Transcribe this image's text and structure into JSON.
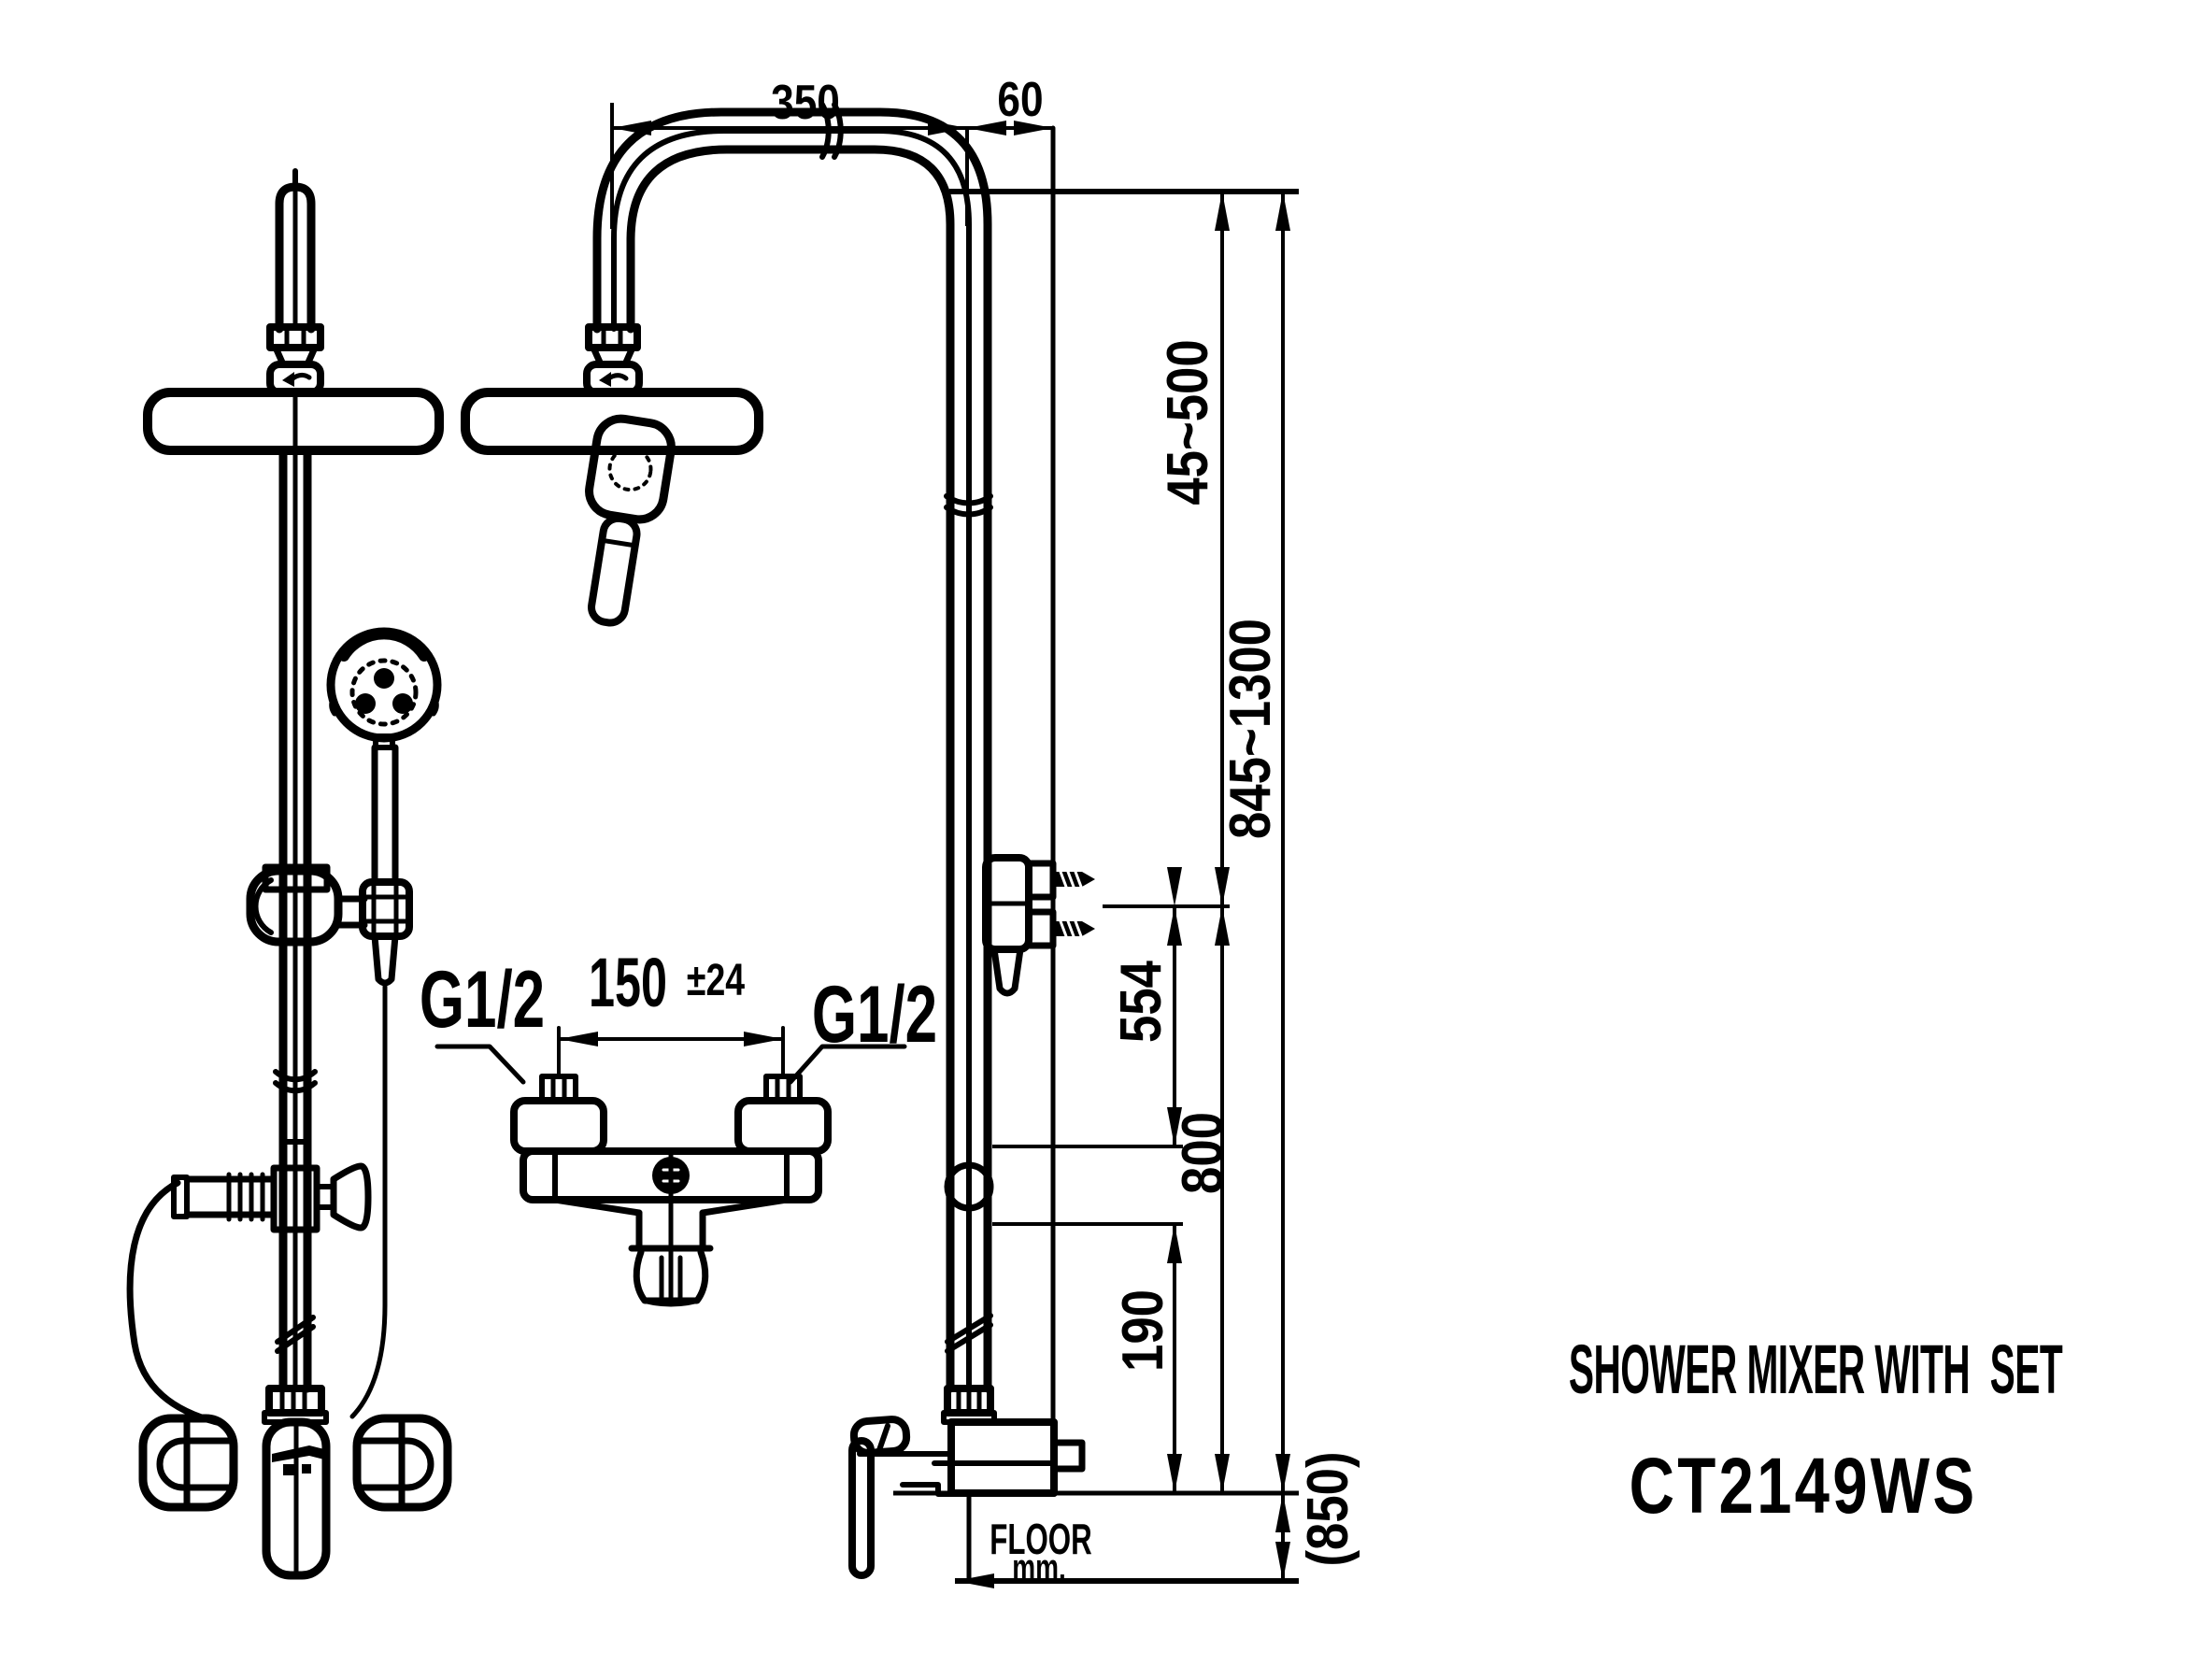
{
  "title": {
    "product_name": "SHOWER MIXER WITH  SET",
    "model_code": "CT2149WS"
  },
  "floor_reference": {
    "label": "FLOOR",
    "unit": "mm."
  },
  "dimensions": {
    "head_to_riser": "350",
    "riser_to_wall": "60",
    "head_height_adjust": "45~500",
    "riser_height_range": "845~1300",
    "bracket_height": "554",
    "outlet_to_mixer": "800",
    "lower_connection": "190",
    "mixer_install_height": "(850)",
    "inlet_spacing": "150",
    "inlet_spacing_tolerance": "±24",
    "left_inlet_thread": "G1/2",
    "right_inlet_thread": "G1/2"
  },
  "colors": {
    "ink": "#000000",
    "paper": "#ffffff"
  }
}
